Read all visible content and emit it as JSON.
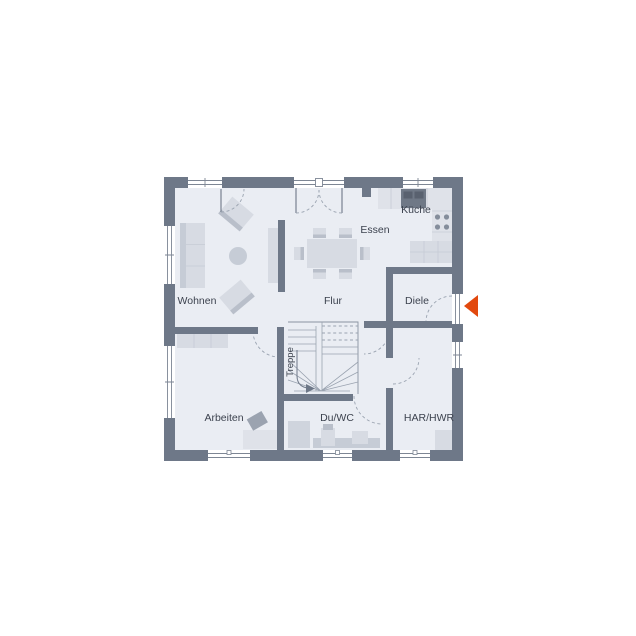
{
  "floorplan": {
    "type": "ground-floor-plan",
    "rooms": [
      {
        "id": "wohnen",
        "label": "Wohnen"
      },
      {
        "id": "essen",
        "label": "Essen"
      },
      {
        "id": "kueche",
        "label": "Küche"
      },
      {
        "id": "flur",
        "label": "Flur"
      },
      {
        "id": "diele",
        "label": "Diele"
      },
      {
        "id": "treppe",
        "label": "Treppe"
      },
      {
        "id": "arbeiten",
        "label": "Arbeiten"
      },
      {
        "id": "duwc",
        "label": "Du/WC"
      },
      {
        "id": "harhwr",
        "label": "HAR/HWR"
      }
    ],
    "entrance_marker": {
      "shape": "triangle-pointing-left",
      "color": "#e2490e"
    },
    "colors": {
      "background": "#ffffff",
      "wall": "#6e7888",
      "floor": "#eaedf3",
      "furniture": "#d7dbe3",
      "furniture_dark": "#b9bfca",
      "line": "#9aa3b0",
      "text": "#3c424e",
      "accent": "#e2490e"
    }
  }
}
